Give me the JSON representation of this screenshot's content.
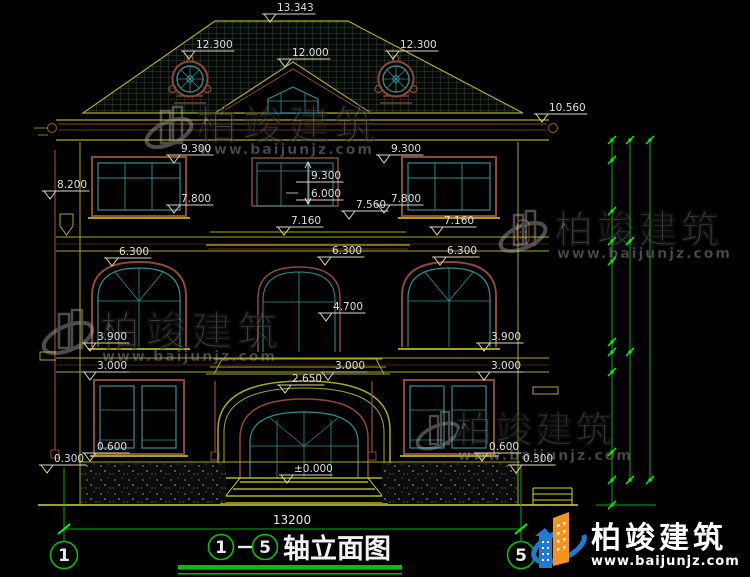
{
  "watermark": {
    "brand": "柏竣建筑",
    "url": "www.baijunjz.com"
  },
  "logo": {
    "brand": "柏竣建筑",
    "url": "www.baijunjz.com"
  },
  "title": {
    "axis_from": "1",
    "axis_to": "5",
    "separator": "-",
    "text": "轴立面图"
  },
  "axis_bubbles": {
    "left": "1",
    "right": "5"
  },
  "bottom_dimension": "13200",
  "colors": {
    "background": "#000000",
    "wall_line": "#a9a91c",
    "bright_line": "#d8d81e",
    "frame_brown": "#8c4a2f",
    "glazing_teal": "#2f9090",
    "dim_green": "#00b400",
    "tick_green": "#00ff00",
    "dim_text": "#dedede",
    "logo_blue": "#1e7ad2",
    "logo_orange": "#f6921e"
  },
  "elevation_labels": [
    {
      "t": "13.343",
      "x": 277,
      "y": 11
    },
    {
      "t": "12.300",
      "x": 196,
      "y": 48
    },
    {
      "t": "12.000",
      "x": 292,
      "y": 56
    },
    {
      "t": "12.300",
      "x": 400,
      "y": 48
    },
    {
      "t": "10.560",
      "x": 549,
      "y": 111
    },
    {
      "t": "9.300",
      "x": 181,
      "y": 152
    },
    {
      "t": "9.300",
      "x": 391,
      "y": 152
    },
    {
      "t": "8.200",
      "x": 57,
      "y": 188
    },
    {
      "t": "7.800",
      "x": 181,
      "y": 202
    },
    {
      "t": "7.800",
      "x": 391,
      "y": 202
    },
    {
      "t": "7.560",
      "x": 356,
      "y": 208
    },
    {
      "t": "7.160",
      "x": 291,
      "y": 224
    },
    {
      "t": "7.160",
      "x": 444,
      "y": 224
    },
    {
      "t": "6.300",
      "x": 119,
      "y": 255
    },
    {
      "t": "6.300",
      "x": 332,
      "y": 254
    },
    {
      "t": "6.300",
      "x": 447,
      "y": 254
    },
    {
      "t": "9.300",
      "x": 311,
      "y": 179,
      "style": "ul"
    },
    {
      "t": "6.000",
      "x": 311,
      "y": 197,
      "style": "ul"
    },
    {
      "t": "4.700",
      "x": 333,
      "y": 310
    },
    {
      "t": "3.900",
      "x": 97,
      "y": 340
    },
    {
      "t": "3.900",
      "x": 491,
      "y": 340
    },
    {
      "t": "3.000",
      "x": 97,
      "y": 369
    },
    {
      "t": "3.000",
      "x": 335,
      "y": 369
    },
    {
      "t": "3.000",
      "x": 491,
      "y": 369
    },
    {
      "t": "2.650",
      "x": 292,
      "y": 382
    },
    {
      "t": "0.600",
      "x": 97,
      "y": 450
    },
    {
      "t": "0.300",
      "x": 54,
      "y": 462
    },
    {
      "t": "±0.000",
      "x": 294,
      "y": 472
    },
    {
      "t": "0.600",
      "x": 489,
      "y": 450
    },
    {
      "t": "0.300",
      "x": 523,
      "y": 462
    }
  ],
  "right_levels": [
    {
      "label": "9.900(4F)",
      "tx": 661,
      "ty": 126,
      "line": [
        573,
        686,
        140
      ],
      "tri": 667
    },
    {
      "label": "6.900(3F)",
      "tx": 651,
      "ty": 231,
      "line": [
        648,
        702,
        239
      ],
      "tri": 660
    },
    {
      "label": "3.600(2F)",
      "tx": 657,
      "ty": 344,
      "line": [
        653,
        712,
        352
      ],
      "tri": 666
    },
    {
      "label": "±0.000(1F)",
      "tx": 653,
      "ty": 471,
      "line": [
        650,
        712,
        480
      ],
      "tri": 666
    }
  ],
  "right_chain": {
    "lines": [
      {
        "x": 612,
        "y1": 140,
        "y2": 505
      },
      {
        "x": 630,
        "y1": 140,
        "y2": 480
      },
      {
        "x": 650,
        "y1": 140,
        "y2": 480
      }
    ],
    "ticks": [
      {
        "x": 612,
        "ys": [
          140,
          160,
          211,
          241,
          261,
          342,
          352,
          372,
          452,
          480,
          505
        ]
      },
      {
        "x": 630,
        "ys": [
          140,
          241,
          352,
          480
        ]
      },
      {
        "x": 650,
        "ys": [
          140,
          480
        ]
      }
    ],
    "labels": [
      {
        "v": "600",
        "x": 601,
        "y": 150
      },
      {
        "v": "1500",
        "x": 601,
        "y": 186
      },
      {
        "v": "900",
        "x": 601,
        "y": 226
      },
      {
        "v": "600",
        "x": 601,
        "y": 251
      },
      {
        "v": "2400",
        "x": 601,
        "y": 302
      },
      {
        "v": "300",
        "x": 601,
        "y": 349
      },
      {
        "v": "600",
        "x": 601,
        "y": 363
      },
      {
        "v": "2400",
        "x": 601,
        "y": 412
      },
      {
        "v": "600",
        "x": 601,
        "y": 466
      },
      {
        "v": "750",
        "x": 628,
        "y": 492
      },
      {
        "v": "3000",
        "x": 620,
        "y": 191
      },
      {
        "v": "3300",
        "x": 620,
        "y": 297
      },
      {
        "v": "3600",
        "x": 620,
        "y": 416
      },
      {
        "v": "9900",
        "x": 659,
        "y": 310
      }
    ]
  }
}
